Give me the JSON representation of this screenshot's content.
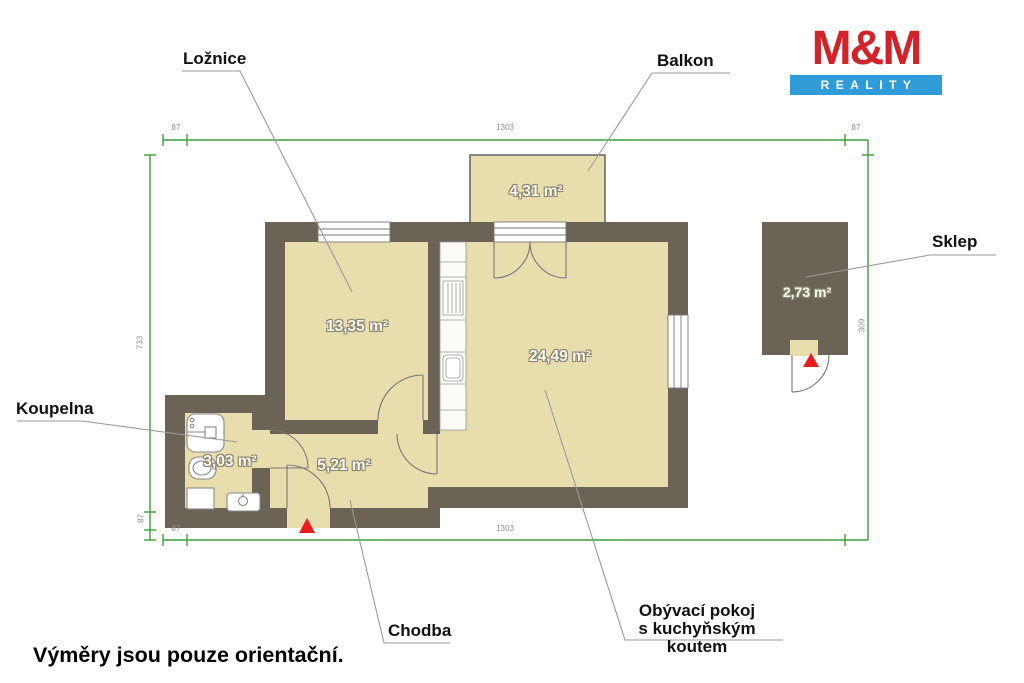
{
  "logo": {
    "top": "M&M",
    "bottom": "REALITY"
  },
  "footer_note": "Výměry jsou pouze orientační.",
  "rooms": {
    "loznice": {
      "label": "Ložnice",
      "area": "13,35 m²"
    },
    "balkon": {
      "label": "Balkon",
      "area": "4,31 m²"
    },
    "obyvaci": {
      "label": "Obývací pokoj",
      "label2": "s kuchyňským koutem",
      "area": "24,49 m²"
    },
    "chodba": {
      "label": "Chodba",
      "area": "5,21 m²"
    },
    "koupelna": {
      "label": "Koupelna",
      "area": "3,03 m²"
    },
    "sklep": {
      "label": "Sklep",
      "area": "2,73 m²"
    }
  },
  "dimensions": {
    "top_total": "1303",
    "bottom_total": "1303",
    "left_total": "733",
    "right_total": "309",
    "top_left_offset": "87",
    "top_right_offset": "87",
    "bottom_left_offset": "87",
    "left_step_offset": "87"
  },
  "colors": {
    "wall": "#6c6357",
    "room_fill": "#e8ddad",
    "dimension_green": "#3f9e3f",
    "entrance_red": "#ea1c1c",
    "logo_red": "#d2232a",
    "logo_blue": "#2f9cd8"
  }
}
